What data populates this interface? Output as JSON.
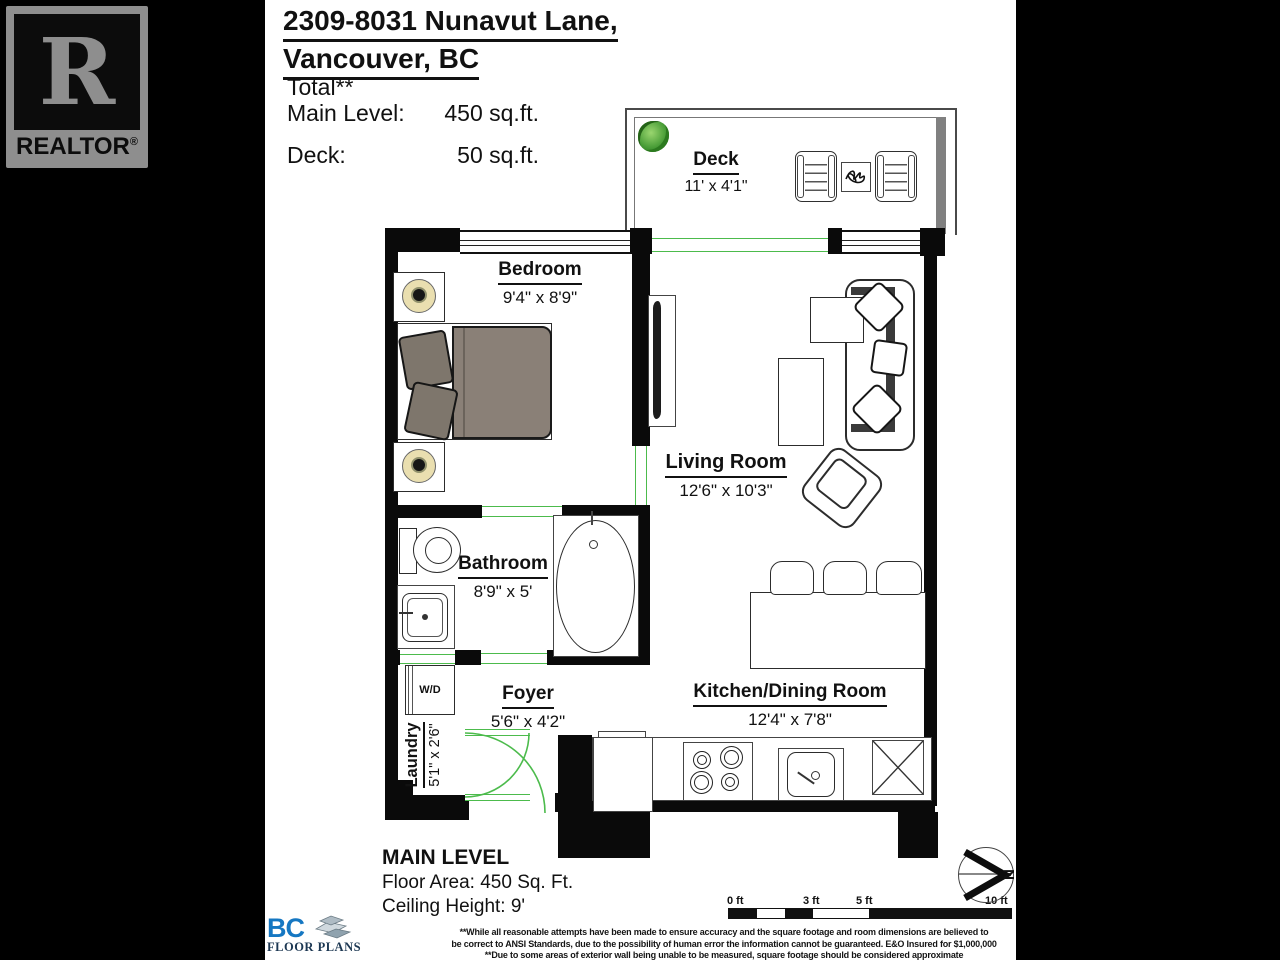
{
  "branding": {
    "realtor_r": "R",
    "realtor_label": "REALTOR",
    "realtor_reg": "®",
    "bc_abbrev": "BC",
    "bc_label": "FLOOR PLANS"
  },
  "header": {
    "address_line1": "2309-8031 Nunavut Lane,",
    "address_line2": "Vancouver, BC",
    "total_label": "Total**",
    "area_rows": [
      {
        "label": "Main Level:",
        "value": "450 sq.ft."
      },
      {
        "label": "Deck:",
        "value": "50 sq.ft."
      }
    ]
  },
  "rooms": [
    {
      "name": "Deck",
      "dims": "11' x 4'1\""
    },
    {
      "name": "Bedroom",
      "dims": "9'4\" x 8'9\""
    },
    {
      "name": "Living Room",
      "dims": "12'6\" x 10'3\""
    },
    {
      "name": "Bathroom",
      "dims": "8'9\" x 5'"
    },
    {
      "name": "Foyer",
      "dims": "5'6\" x 4'2\""
    },
    {
      "name": "Laundry",
      "dims": "5'1\" x 2'6\""
    },
    {
      "name": "Kitchen/Dining Room",
      "dims": "12'4\" x 7'8\""
    }
  ],
  "fixtures": {
    "washer_dryer": "W/D"
  },
  "level_summary": {
    "title": "MAIN LEVEL",
    "floor_area": "Floor Area: 450 Sq. Ft.",
    "ceiling_height": "Ceiling Height: 9'"
  },
  "disclaimer": {
    "line1": "**While all reasonable attempts have been made to ensure accuracy and the square footage and room dimensions are believed to",
    "line2": "be correct to ANSI Standards, due to the possibility of human error the information cannot be guaranteed. E&O Insured for $1,000,000",
    "line3": "**Due to some areas of exterior wall being unable to be measured, square footage should be considered approximate"
  },
  "scale_bar": {
    "tick_labels": [
      "0 ft",
      "3 ft",
      "5 ft",
      "10 ft"
    ]
  },
  "compass": {
    "north_label": "N"
  },
  "colors": {
    "wall": "#0a0a0a",
    "door_window_accent": "#4cbb4c",
    "bed_blanket": "#8a8077",
    "pillow": "#7e766c",
    "lamp_shade": "#eadfb0",
    "realtor_grey": "#8e8e8e",
    "bc_blue": "#1577c2",
    "background": "#000000",
    "canvas": "#ffffff"
  }
}
